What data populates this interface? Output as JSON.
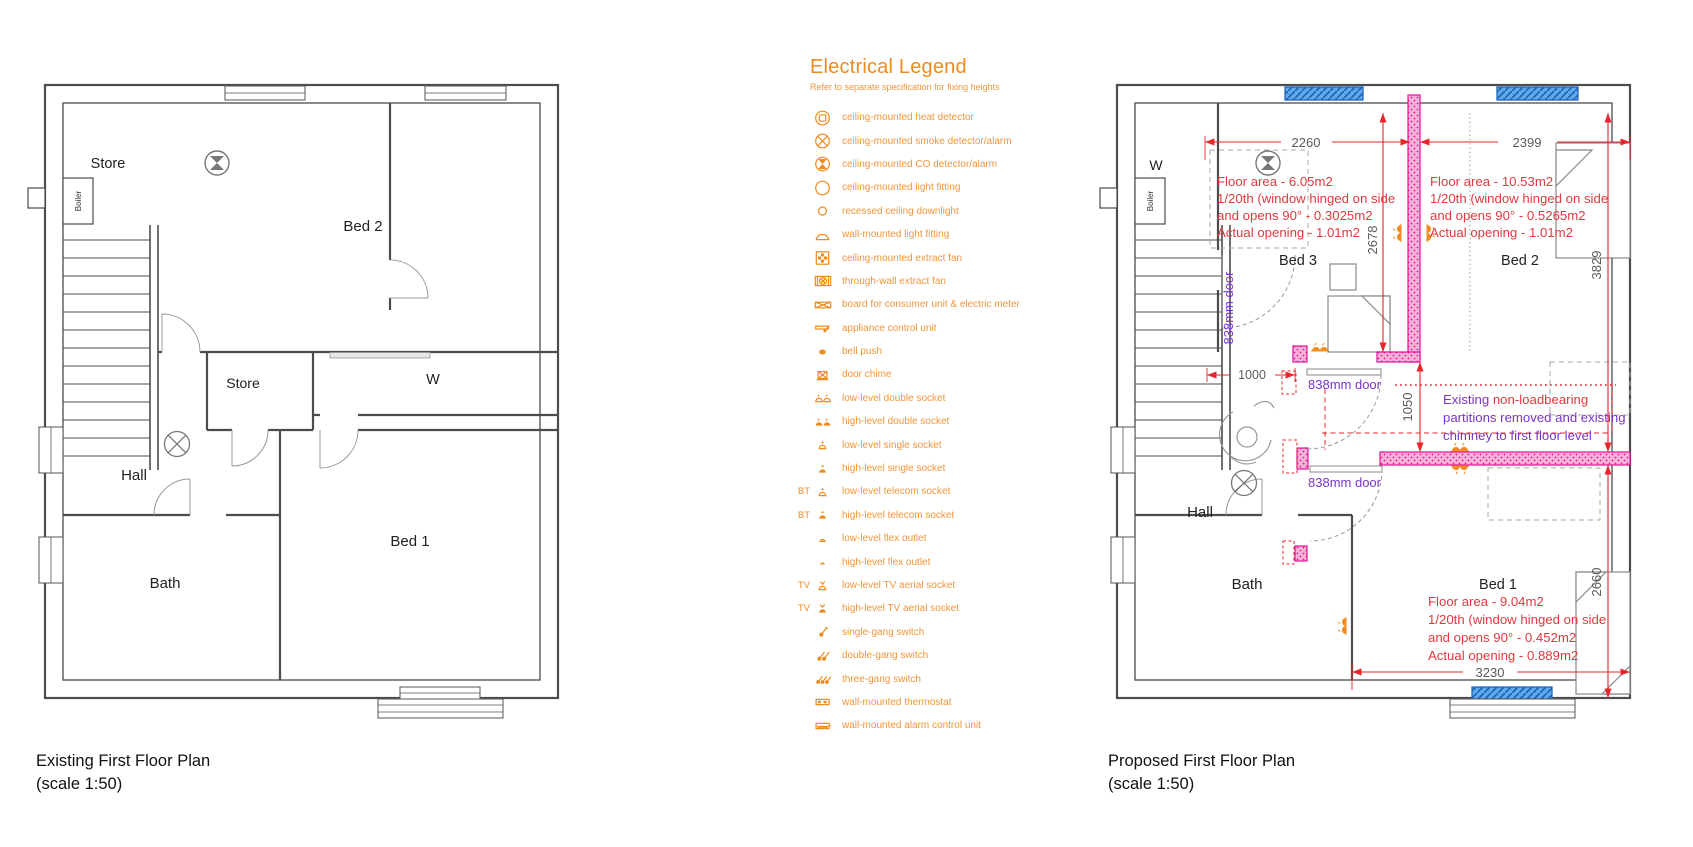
{
  "colors": {
    "legend_orange": "#EF8A1E",
    "annotation_red": "#E0393E",
    "dimension_line_red": "#E8252A",
    "note_purple": "#7A35C8",
    "new_wall_pink": "#F8B4D6",
    "new_wall_magenta": "#E2119B",
    "window_blue": "#5FA8EC",
    "wall_gray": "#4C4C4C"
  },
  "legend": {
    "title": "Electrical Legend",
    "subtitle": "Refer to separate specification for fixing heights",
    "items": [
      {
        "icon": "heat-detector",
        "label": "ceiling-mounted heat detector"
      },
      {
        "icon": "smoke-detector",
        "label": "ceiling-mounted smoke detector/alarm"
      },
      {
        "icon": "co-detector",
        "label": "ceiling-mounted CO detector/alarm"
      },
      {
        "icon": "light-fitting",
        "label": "ceiling-mounted light fitting"
      },
      {
        "icon": "downlight",
        "label": "recessed ceiling downlight"
      },
      {
        "icon": "wall-light",
        "label": "wall-mounted light fitting"
      },
      {
        "icon": "ceiling-extract-fan",
        "label": "ceiling-mounted extract fan"
      },
      {
        "icon": "through-wall-extract-fan",
        "label": "through-wall extract fan"
      },
      {
        "icon": "consumer-board",
        "label": "board for consumer unit & electric meter"
      },
      {
        "icon": "appliance-control-unit",
        "label": "appliance control unit"
      },
      {
        "icon": "bell-push",
        "label": "bell push"
      },
      {
        "icon": "door-chime",
        "label": "door chime"
      },
      {
        "icon": "low-double-socket",
        "label": "low-level double socket"
      },
      {
        "icon": "high-double-socket",
        "label": "high-level double socket"
      },
      {
        "icon": "low-single-socket",
        "label": "low-level single socket"
      },
      {
        "icon": "high-single-socket",
        "label": "high-level single socket"
      },
      {
        "icon": "low-telecom-socket",
        "prefix": "BT",
        "label": "low-level telecom socket"
      },
      {
        "icon": "high-telecom-socket",
        "prefix": "BT",
        "label": "high-level telecom socket"
      },
      {
        "icon": "low-flex-outlet",
        "label": "low-level flex outlet"
      },
      {
        "icon": "high-flex-outlet",
        "label": "high-level flex outlet"
      },
      {
        "icon": "low-tv-socket",
        "prefix": "TV",
        "label": "low-level TV aerial socket"
      },
      {
        "icon": "high-tv-socket",
        "prefix": "TV",
        "label": "high-level TV aerial socket"
      },
      {
        "icon": "single-gang-switch",
        "label": "single-gang switch"
      },
      {
        "icon": "double-gang-switch",
        "label": "double-gang switch"
      },
      {
        "icon": "three-gang-switch",
        "label": "three-gang switch"
      },
      {
        "icon": "thermostat",
        "label": "wall-mounted thermostat"
      },
      {
        "icon": "alarm-control-unit",
        "label": "wall-mounted alarm control unit"
      }
    ]
  },
  "existing": {
    "title": "Existing First Floor Plan",
    "scale": "(scale 1:50)",
    "rooms": {
      "store_top": "Store",
      "boiler": "Boiler",
      "bed2": "Bed 2",
      "store_mid": "Store",
      "wardrobe": "W",
      "hall": "Hall",
      "bath": "Bath",
      "bed1": "Bed 1"
    }
  },
  "proposed": {
    "title": "Proposed First Floor Plan",
    "scale": "(scale 1:50)",
    "rooms": {
      "wardrobe": "W",
      "boiler": "Boiler",
      "bed3": "Bed 3",
      "bed2": "Bed 2",
      "hall": "Hall",
      "bath": "Bath",
      "bed1": "Bed 1"
    },
    "dims": {
      "top_left": "2260",
      "top_right": "2399",
      "bed3_height": "2678",
      "bed2_height": "3829",
      "landing": "1000",
      "offset": "1050",
      "bed1_height": "2660",
      "bottom": "3230"
    },
    "doors": {
      "d1": "838mm door",
      "d2": "838mm door",
      "d3": "838mm door"
    },
    "notes": {
      "bed3": [
        "Floor area - 6.05m2",
        "1/20th (window hinged on side",
        "and opens 90° - 0.3025m2",
        "Actual opening - 1.01m2"
      ],
      "bed2": [
        "Floor area - 10.53m2",
        "1/20th (window hinged on side",
        "and opens 90° - 0.5265m2",
        "Actual opening - 1.01m2"
      ],
      "bed1": [
        "Floor area - 9.04m2",
        "1/20th (window hinged on side",
        "and opens 90° - 0.452m2",
        "Actual opening - 0.889m2"
      ]
    },
    "partition_note": {
      "p1": "Existing ",
      "r1": "non-loadbearing",
      "l2": "partitions removed and existing",
      "l3": "chimney to first floor level"
    }
  }
}
